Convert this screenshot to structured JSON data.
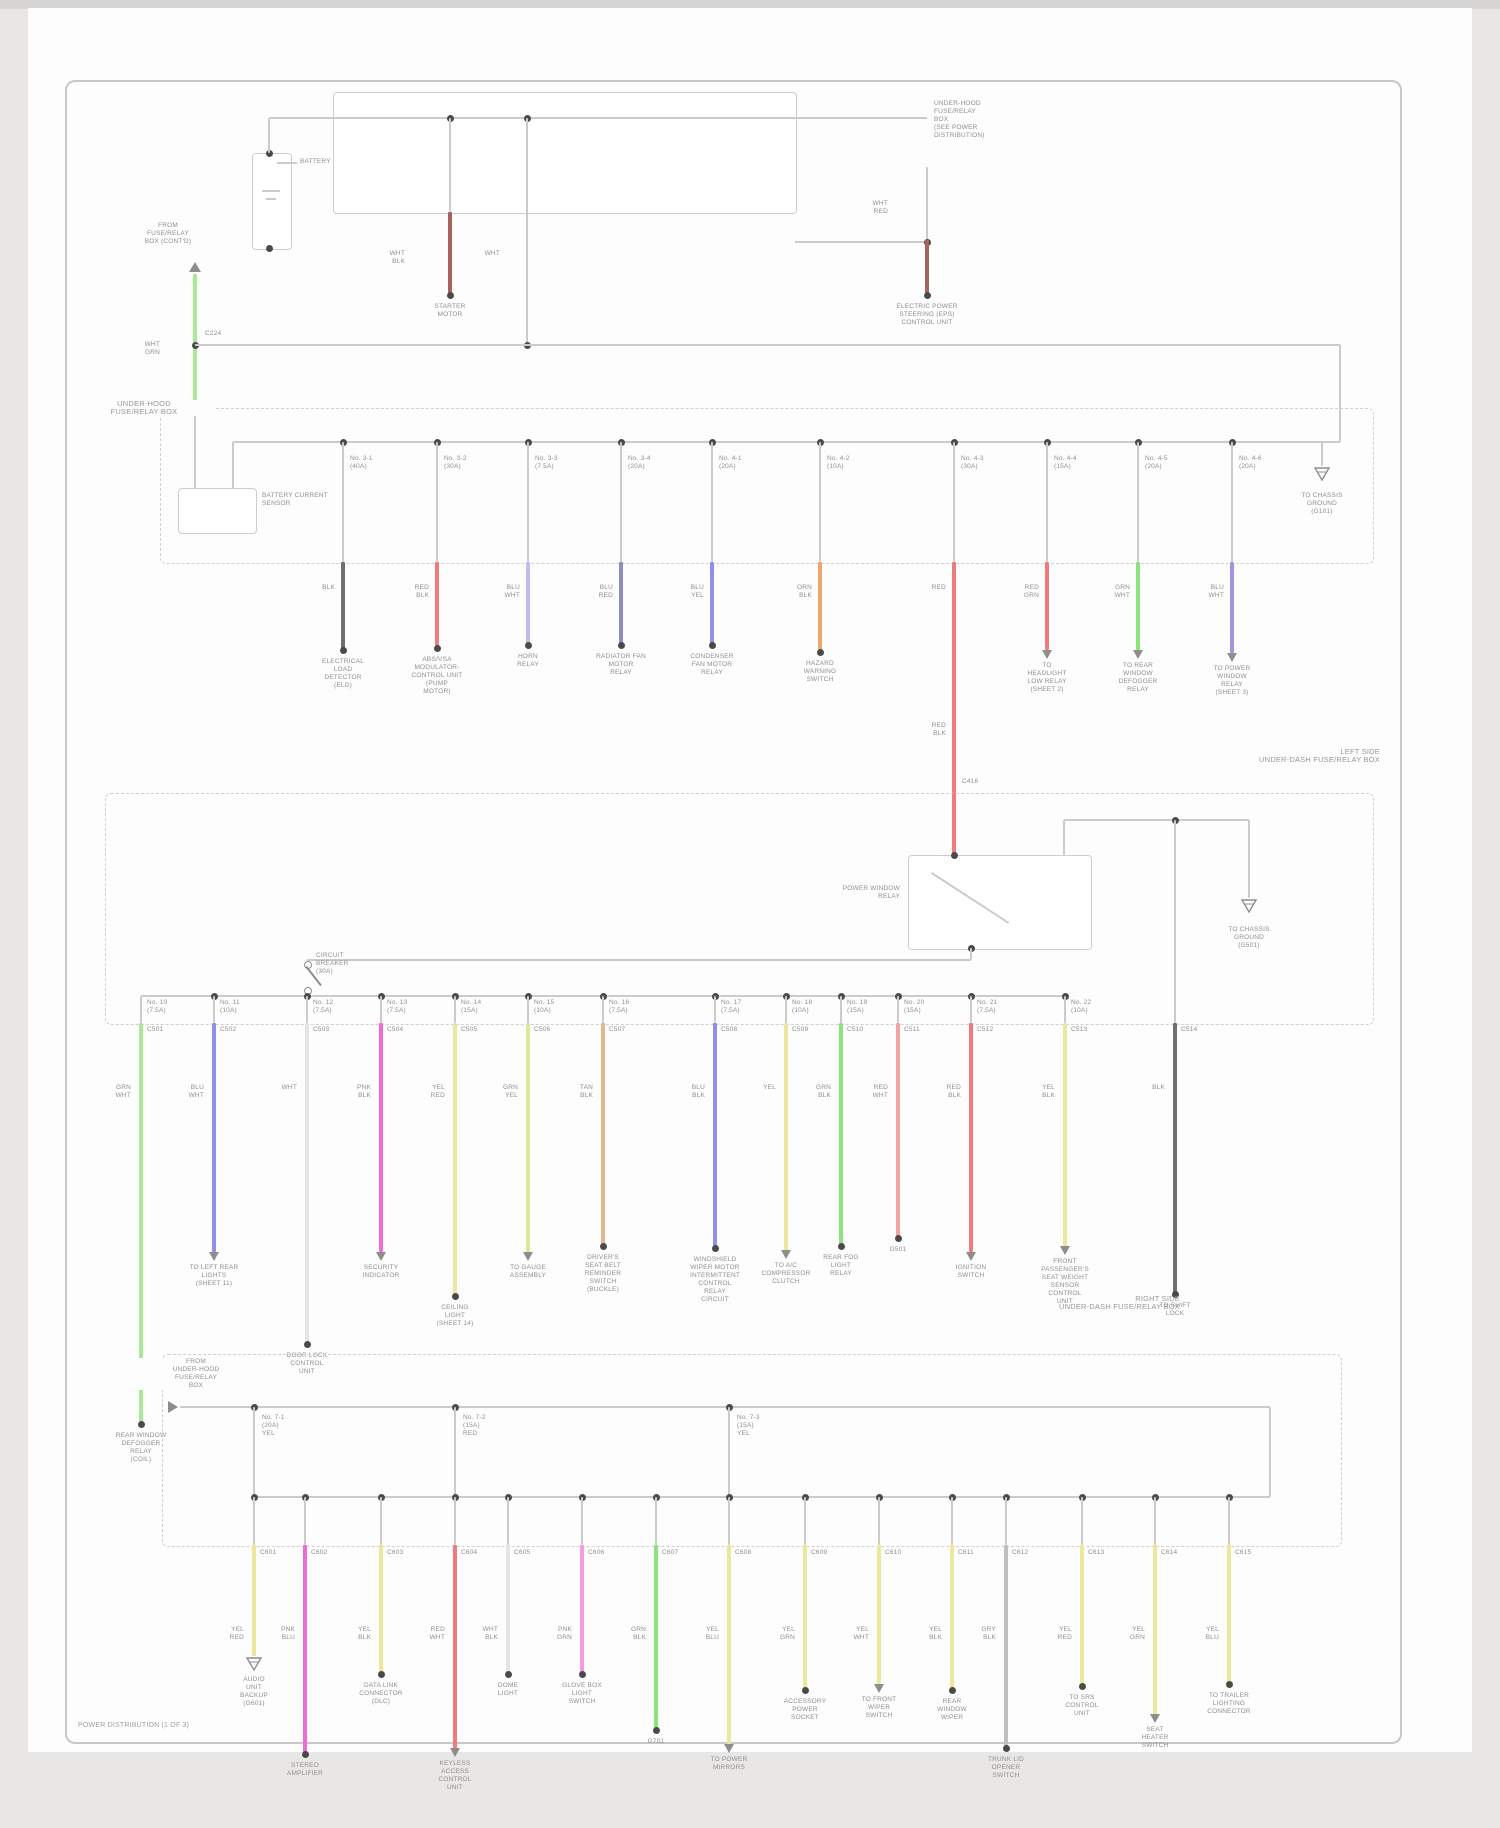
{
  "title": "POWER DISTRIBUTION (1 OF 3)",
  "palette": {
    "line": "#cdcbca",
    "dash": "#d2d0cf",
    "dot": "#4a4a4a",
    "icon": "#8f8d8c",
    "text": "#8f8f8f",
    "wires": {
      "BLK": "#6f6f6f",
      "GRY": "#c0bfbe",
      "WHT": "#e6e5e3",
      "RED": "#ef7b7b",
      "LRD": "#f2a3a3",
      "DRD": "#a86260",
      "PNK": "#f79ae2",
      "MAG": "#f06ada",
      "ORN": "#eaa76e",
      "TAN": "#dfb88d",
      "PYL": "#ebe89e",
      "YGR": "#d6ec92",
      "GRN": "#8de47d",
      "LGR": "#a9e895",
      "BLU": "#9090e8",
      "LAV": "#bdbdee",
      "NVY": "#8d8dc6",
      "VIO": "#a493e4"
    }
  },
  "top": {
    "battery_label": "BATTERY",
    "dest_block": [
      "UNDER-HOOD",
      "FUSE/RELAY",
      "BOX",
      "(SEE POWER",
      "DISTRIBUTION)"
    ],
    "source_block": [
      "FROM",
      "FUSE/RELAY",
      "BOX (CONT'D)"
    ],
    "source_code": [
      "WHT",
      "GRN"
    ],
    "source_conn": "C224",
    "box_label": [
      "UNDER-HOOD",
      "FUSE/RELAY BOX"
    ],
    "sensor_label": [
      "BATTERY CURRENT",
      "SENSOR"
    ],
    "inner_ground": [
      "TO CHASSIS",
      "GROUND",
      "(G101)"
    ],
    "taps": [
      {
        "x": 450,
        "code": [
          "WHT",
          "BLK"
        ],
        "comp": [
          "STARTER",
          "MOTOR"
        ]
      },
      {
        "x": 527,
        "code": [
          "WHT",
          ""
        ],
        "comp": []
      },
      {
        "x": 927,
        "code": [
          "WHT",
          "RED"
        ],
        "comp": [
          "ELECTRIC POWER",
          "STEERING (EPS)",
          "CONTROL UNIT"
        ]
      }
    ],
    "drops": [
      {
        "x": 343,
        "wire": "BLK",
        "code": [
          "BLK",
          ""
        ],
        "fuse": [
          "No. 3-1",
          "(40A)"
        ],
        "conn": "C301",
        "end": "dot",
        "endY": 650,
        "comp": [
          "ELECTRICAL",
          "LOAD",
          "DETECTOR",
          "(ELD)"
        ]
      },
      {
        "x": 437,
        "wire": "RED",
        "code": [
          "RED",
          "BLK"
        ],
        "fuse": [
          "No. 3-2",
          "(30A)"
        ],
        "conn": "C302",
        "end": "dot",
        "endY": 648,
        "comp": [
          "ABS/VSA",
          "MODULATOR-",
          "CONTROL UNIT",
          "(PUMP",
          "MOTOR)"
        ]
      },
      {
        "x": 528,
        "wire": "LAV",
        "code": [
          "BLU",
          "WHT"
        ],
        "fuse": [
          "No. 3-3",
          "(7.5A)"
        ],
        "conn": "C303",
        "end": "dot",
        "endY": 645,
        "comp": [
          "HORN",
          "RELAY"
        ]
      },
      {
        "x": 621,
        "wire": "NVY",
        "code": [
          "BLU",
          "RED"
        ],
        "fuse": [
          "No. 3-4",
          "(20A)"
        ],
        "conn": "C304",
        "end": "dot",
        "endY": 645,
        "comp": [
          "RADIATOR FAN",
          "MOTOR",
          "RELAY"
        ]
      },
      {
        "x": 712,
        "wire": "BLU",
        "code": [
          "BLU",
          "YEL"
        ],
        "fuse": [
          "No. 4-1",
          "(20A)"
        ],
        "conn": "C305",
        "end": "dot",
        "endY": 645,
        "comp": [
          "CONDENSER",
          "FAN MOTOR",
          "RELAY"
        ]
      },
      {
        "x": 820,
        "wire": "ORN",
        "code": [
          "ORN",
          "BLK"
        ],
        "fuse": [
          "No. 4-2",
          "(10A)"
        ],
        "conn": "C306",
        "end": "dot",
        "endY": 652,
        "comp": [
          "HAZARD",
          "WARNING",
          "SWITCH"
        ]
      },
      {
        "x": 954,
        "wire": "RED",
        "code": [
          "RED",
          ""
        ],
        "fuse": [
          "No. 4-3",
          "(30A)"
        ],
        "conn": "C416",
        "end": "none",
        "endY": 793,
        "comp": []
      },
      {
        "x": 1047,
        "wire": "RED",
        "code": [
          "RED",
          "GRN"
        ],
        "fuse": [
          "No. 4-4",
          "(15A)"
        ],
        "conn": "C308",
        "end": "arrow",
        "endY": 650,
        "comp": [
          "TO",
          "HEADLIGHT",
          "LOW RELAY",
          "(SHEET 2)"
        ]
      },
      {
        "x": 1138,
        "wire": "GRN",
        "code": [
          "GRN",
          "WHT"
        ],
        "fuse": [
          "No. 4-5",
          "(20A)"
        ],
        "conn": "C309",
        "end": "arrow",
        "endY": 650,
        "comp": [
          "TO REAR",
          "WINDOW",
          "DEFOGGER",
          "RELAY"
        ]
      },
      {
        "x": 1232,
        "wire": "VIO",
        "code": [
          "BLU",
          "WHT"
        ],
        "fuse": [
          "No. 4-6",
          "(20A)"
        ],
        "conn": "C310",
        "end": "arrow",
        "endY": 653,
        "comp": [
          "TO POWER",
          "WINDOW",
          "RELAY",
          "(SHEET 3)"
        ]
      }
    ],
    "feed_code2": [
      "RED",
      "BLK"
    ]
  },
  "middle": {
    "caption": [
      "LEFT SIDE",
      "UNDER-DASH FUSE/RELAY BOX"
    ],
    "relay_label": [
      "POWER WINDOW",
      "RELAY"
    ],
    "breaker_label": [
      "CIRCUIT",
      "BREAKER",
      "(30A)"
    ],
    "ground_label": [
      "TO CHASSIS",
      "GROUND",
      "(G501)"
    ],
    "drops": [
      {
        "x": 141,
        "wire": "LGR",
        "code": [
          "GRN",
          "WHT"
        ],
        "fuse": [
          "No. 10",
          "(7.5A)"
        ],
        "conn": "C501",
        "end": "dot",
        "endY": 1424,
        "comp": [
          "REAR WINDOW",
          "DEFOGGER",
          "RELAY",
          "(COIL)"
        ]
      },
      {
        "x": 214,
        "wire": "BLU",
        "code": [
          "BLU",
          "WHT"
        ],
        "fuse": [
          "No. 11",
          "(10A)"
        ],
        "conn": "C502",
        "end": "arrow",
        "endY": 1252,
        "comp": [
          "TO LEFT REAR",
          "LIGHTS",
          "(SHEET 11)"
        ]
      },
      {
        "x": 307,
        "wire": "WHT",
        "code": [
          "WHT",
          ""
        ],
        "fuse": [
          "No. 12",
          "(7.5A)"
        ],
        "conn": "C503",
        "end": "dot",
        "endY": 1344,
        "comp": [
          "DOOR LOCK",
          "CONTROL",
          "UNIT"
        ]
      },
      {
        "x": 381,
        "wire": "MAG",
        "code": [
          "PNK",
          "BLK"
        ],
        "fuse": [
          "No. 13",
          "(7.5A)"
        ],
        "conn": "C504",
        "end": "arrow",
        "endY": 1252,
        "comp": [
          "SECURITY",
          "INDICATOR"
        ]
      },
      {
        "x": 455,
        "wire": "PYL",
        "code": [
          "YEL",
          "RED"
        ],
        "fuse": [
          "No. 14",
          "(15A)"
        ],
        "conn": "C505",
        "end": "dot",
        "endY": 1296,
        "comp": [
          "CEILING",
          "LIGHT",
          "(SHEET 14)"
        ]
      },
      {
        "x": 528,
        "wire": "YGR",
        "code": [
          "GRN",
          "YEL"
        ],
        "fuse": [
          "No. 15",
          "(10A)"
        ],
        "conn": "C506",
        "end": "arrow",
        "endY": 1252,
        "comp": [
          "TO GAUGE",
          "ASSEMBLY"
        ]
      },
      {
        "x": 603,
        "wire": "TAN",
        "code": [
          "TAN",
          "BLK"
        ],
        "fuse": [
          "No. 16",
          "(7.5A)"
        ],
        "conn": "C507",
        "end": "dot",
        "endY": 1246,
        "comp": [
          "DRIVER'S",
          "SEAT BELT",
          "REMINDER",
          "SWITCH",
          "(BUCKLE)"
        ]
      },
      {
        "x": 715,
        "wire": "BLU",
        "code": [
          "BLU",
          "BLK"
        ],
        "fuse": [
          "No. 17",
          "(7.5A)"
        ],
        "conn": "C508",
        "end": "dot",
        "endY": 1248,
        "comp": [
          "WINDSHIELD",
          "WIPER MOTOR",
          "INTERMITTENT",
          "CONTROL",
          "RELAY",
          "CIRCUIT"
        ]
      },
      {
        "x": 786,
        "wire": "PYL",
        "code": [
          "YEL",
          ""
        ],
        "fuse": [
          "No. 18",
          "(10A)"
        ],
        "conn": "C509",
        "end": "arrow",
        "endY": 1250,
        "comp": [
          "TO A/C",
          "COMPRESSOR",
          "CLUTCH"
        ]
      },
      {
        "x": 841,
        "wire": "GRN",
        "code": [
          "GRN",
          "BLK"
        ],
        "fuse": [
          "No. 19",
          "(15A)"
        ],
        "conn": "C510",
        "end": "dot",
        "endY": 1246,
        "comp": [
          "REAR FOG",
          "LIGHT",
          "RELAY"
        ]
      },
      {
        "x": 898,
        "wire": "LRD",
        "code": [
          "RED",
          "WHT"
        ],
        "fuse": [
          "No. 20",
          "(15A)"
        ],
        "conn": "C511",
        "end": "dot",
        "endY": 1238,
        "comp": [
          "G501"
        ]
      },
      {
        "x": 971,
        "wire": "RED",
        "code": [
          "RED",
          "BLK"
        ],
        "fuse": [
          "No. 21",
          "(7.5A)"
        ],
        "conn": "C512",
        "end": "arrow",
        "endY": 1252,
        "comp": [
          "IGNITION",
          "SWITCH"
        ]
      },
      {
        "x": 1065,
        "wire": "PYL",
        "code": [
          "YEL",
          "BLK"
        ],
        "fuse": [
          "No. 22",
          "(10A)"
        ],
        "conn": "C513",
        "end": "arrow",
        "endY": 1246,
        "comp": [
          "FRONT",
          "PASSENGER'S",
          "SEAT WEIGHT",
          "SENSOR",
          "CONTROL",
          "UNIT"
        ]
      },
      {
        "x": 1175,
        "wire": "BLK",
        "code": [
          "BLK",
          ""
        ],
        "fuse": null,
        "conn": "C514",
        "end": "dot",
        "endY": 1294,
        "comp": [
          "TO SHIFT",
          "LOCK"
        ]
      }
    ]
  },
  "bottom": {
    "caption": [
      "RIGHT SIDE",
      "UNDER-DASH FUSE/RELAY BOX"
    ],
    "connector_label": [
      "FROM",
      "UNDER-HOOD",
      "FUSE/RELAY",
      "BOX"
    ],
    "feeds": [
      {
        "x": 254,
        "fuse": [
          "No. 7-1",
          "(20A)",
          "YEL"
        ]
      },
      {
        "x": 455,
        "fuse": [
          "No. 7-2",
          "(15A)",
          "RED"
        ]
      },
      {
        "x": 729,
        "fuse": [
          "No. 7-3",
          "(15A)",
          "YEL"
        ]
      }
    ],
    "drops": [
      {
        "x": 254,
        "wire": "PYL",
        "code": [
          "YEL",
          "RED"
        ],
        "conn": "C601",
        "end": "ground",
        "endY": 1656,
        "comp": [
          "AUDIO",
          "UNIT",
          "BACKUP",
          "(G601)"
        ]
      },
      {
        "x": 305,
        "wire": "MAG",
        "code": [
          "PNK",
          "BLU"
        ],
        "conn": "C602",
        "end": "dot",
        "endY": 1754,
        "comp": [
          "STEREO",
          "AMPLIFIER"
        ]
      },
      {
        "x": 381,
        "wire": "PYL",
        "code": [
          "YEL",
          "BLK"
        ],
        "conn": "C603",
        "end": "dot",
        "endY": 1674,
        "comp": [
          "DATA LINK",
          "CONNECTOR",
          "(DLC)"
        ]
      },
      {
        "x": 455,
        "wire": "RED",
        "code": [
          "RED",
          "WHT"
        ],
        "conn": "C604",
        "end": "arrow",
        "endY": 1748,
        "comp": [
          "KEYLESS",
          "ACCESS",
          "CONTROL",
          "UNIT"
        ]
      },
      {
        "x": 508,
        "wire": "WHT",
        "code": [
          "WHT",
          "BLK"
        ],
        "conn": "C605",
        "end": "dot",
        "endY": 1674,
        "comp": [
          "DOME",
          "LIGHT"
        ]
      },
      {
        "x": 582,
        "wire": "PNK",
        "code": [
          "PNK",
          "GRN"
        ],
        "conn": "C606",
        "end": "dot",
        "endY": 1674,
        "comp": [
          "GLOVE BOX",
          "LIGHT",
          "SWITCH"
        ]
      },
      {
        "x": 656,
        "wire": "GRN",
        "code": [
          "GRN",
          "BLK"
        ],
        "conn": "C607",
        "end": "dot",
        "endY": 1730,
        "comp": [
          "G701"
        ]
      },
      {
        "x": 729,
        "wire": "PYL",
        "code": [
          "YEL",
          "BLU"
        ],
        "conn": "C608",
        "end": "arrow",
        "endY": 1744,
        "comp": [
          "TO POWER",
          "MIRRORS"
        ]
      },
      {
        "x": 805,
        "wire": "PYL",
        "code": [
          "YEL",
          "GRN"
        ],
        "conn": "C609",
        "end": "dot",
        "endY": 1690,
        "comp": [
          "ACCESSORY",
          "POWER",
          "SOCKET"
        ]
      },
      {
        "x": 879,
        "wire": "PYL",
        "code": [
          "YEL",
          "WHT"
        ],
        "conn": "C610",
        "end": "arrow",
        "endY": 1684,
        "comp": [
          "TO FRONT",
          "WIPER",
          "SWITCH"
        ]
      },
      {
        "x": 952,
        "wire": "PYL",
        "code": [
          "YEL",
          "BLK"
        ],
        "conn": "C611",
        "end": "dot",
        "endY": 1690,
        "comp": [
          "REAR",
          "WINDOW",
          "WIPER"
        ]
      },
      {
        "x": 1006,
        "wire": "GRY",
        "code": [
          "GRY",
          "BLK"
        ],
        "conn": "C612",
        "end": "dot",
        "endY": 1748,
        "comp": [
          "TRUNK LID",
          "OPENER",
          "SWITCH"
        ]
      },
      {
        "x": 1082,
        "wire": "PYL",
        "code": [
          "YEL",
          "RED"
        ],
        "conn": "C613",
        "end": "dot",
        "endY": 1686,
        "comp": [
          "TO SRS",
          "CONTROL",
          "UNIT"
        ]
      },
      {
        "x": 1155,
        "wire": "PYL",
        "code": [
          "YEL",
          "GRN"
        ],
        "conn": "C614",
        "end": "arrow",
        "endY": 1714,
        "comp": [
          "SEAT",
          "HEATER",
          "SWITCH"
        ]
      },
      {
        "x": 1229,
        "wire": "PYL",
        "code": [
          "YEL",
          "BLU"
        ],
        "conn": "C615",
        "end": "dot",
        "endY": 1684,
        "comp": [
          "TO TRAILER",
          "LIGHTING",
          "CONNECTOR"
        ]
      }
    ]
  }
}
